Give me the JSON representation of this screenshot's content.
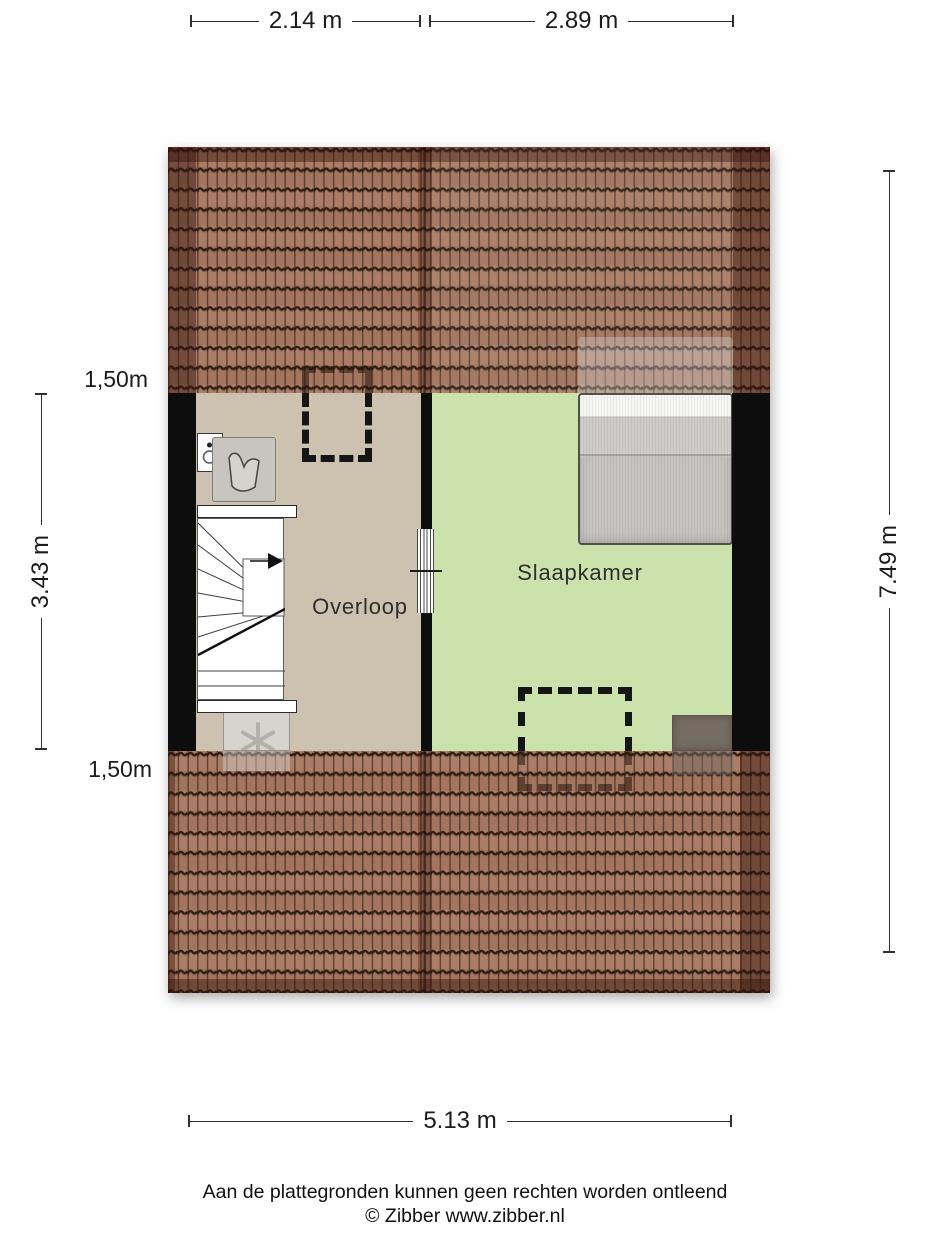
{
  "dimensions": {
    "top_left": "2.14 m",
    "top_right": "2.89 m",
    "bottom": "5.13 m",
    "inner_height": "3.43 m",
    "outer_height": "7.49 m",
    "knee_wall_top": "1,50m",
    "knee_wall_bottom": "1,50m"
  },
  "rooms": {
    "landing": "Overloop",
    "bedroom": "Slaapkamer"
  },
  "footer": {
    "disclaimer": "Aan de plattegronden kunnen geen rechten worden ontleend",
    "copyright": "© Zibber www.zibber.nl"
  },
  "colors": {
    "roof_tile": "#ab7d66",
    "roof_tile_alt": "#a3755f",
    "roof_edge_dark": "#5f3322",
    "floor_landing": "#cdc1b0",
    "floor_bedroom": "#cce2ad",
    "wall": "#0d0d0d",
    "dash_outline": "#151515",
    "text": "#1b1b1b"
  }
}
